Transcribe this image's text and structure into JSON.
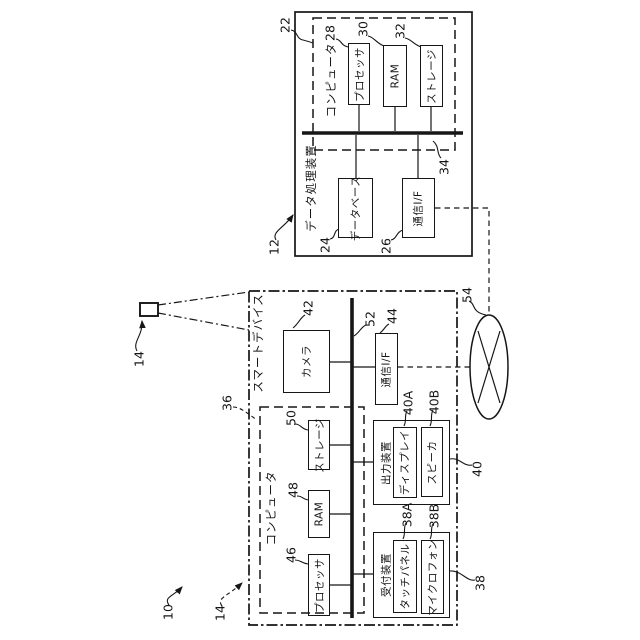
{
  "figure": {
    "system_ref": "10",
    "data_processing_device": {
      "ref": "12",
      "title": "データ処理装置",
      "computer": {
        "ref": "22",
        "title": "コンピュータ",
        "bus_ref": "34",
        "components": [
          {
            "ref": "28",
            "label": "プロセッサ"
          },
          {
            "ref": "30",
            "label": "RAM"
          },
          {
            "ref": "32",
            "label": "ストレージ"
          }
        ]
      },
      "database": {
        "ref": "24",
        "label": "データベース"
      },
      "comm_if": {
        "ref": "26",
        "label": "通信I/F"
      }
    },
    "network": {
      "ref": "54"
    },
    "smart_device": {
      "ref": "14",
      "title": "スマートデバイス",
      "bus_ref": "52",
      "camera": {
        "ref": "42",
        "label": "カメラ"
      },
      "comm_if": {
        "ref": "44",
        "label": "通信I/F"
      },
      "computer": {
        "ref": "36",
        "title": "コンピュータ",
        "components": [
          {
            "ref": "46",
            "label": "プロセッサ"
          },
          {
            "ref": "48",
            "label": "RAM"
          },
          {
            "ref": "50",
            "label": "ストレージ"
          }
        ]
      },
      "output_device": {
        "ref": "40",
        "label": "出力装置",
        "children": [
          {
            "ref": "40A",
            "label": "ディスプレイ"
          },
          {
            "ref": "40B",
            "label": "スピーカ"
          }
        ]
      },
      "input_device": {
        "ref": "38",
        "label": "受付装置",
        "children": [
          {
            "ref": "38A",
            "label": "タッチパネル"
          },
          {
            "ref": "38B",
            "label": "マイクロフォン"
          }
        ]
      }
    },
    "line_color": "#161616"
  }
}
